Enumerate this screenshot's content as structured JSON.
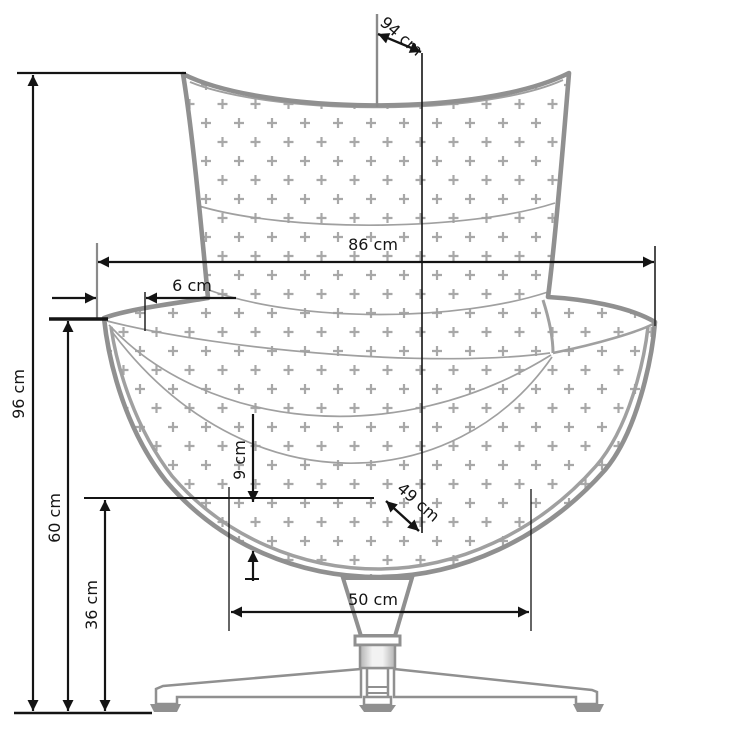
{
  "diagram": {
    "unit": "cm",
    "labels": {
      "total_height": "96 cm",
      "armrest_height": "60 cm",
      "seat_height": "36 cm",
      "back_width": "86 cm",
      "wing_inset": "6 cm",
      "total_depth": "94 cm",
      "seat_depth": "49 cm",
      "cushion_thickness": "9 cm",
      "base_width": "50 cm"
    },
    "values_cm": {
      "total_height": 96,
      "armrest_height": 60,
      "seat_height": 36,
      "back_width": 86,
      "wing_inset": 6,
      "total_depth": 94,
      "seat_depth": 49,
      "cushion_thickness": 9,
      "base_width": 50
    },
    "colors": {
      "outline": "#909090",
      "seam": "#a0a0a0",
      "pattern_plus": "#a8a8a8",
      "dimension": "#141414",
      "background": "#ffffff"
    }
  }
}
